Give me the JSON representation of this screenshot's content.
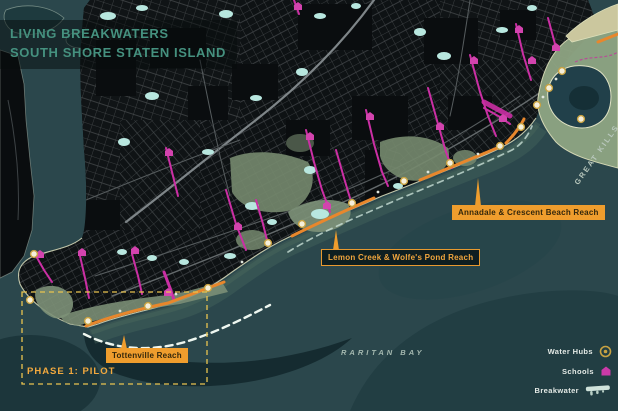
{
  "title": {
    "line1": "LIVING BREAKWATERS",
    "line2": "SOUTH SHORE STATEN ISLAND"
  },
  "map_labels": {
    "reach_annadale": "Annadale & Crescent Beach Reach",
    "reach_lemon": "Lemon Creek & Wolfe's Pond Reach",
    "reach_tottenville": "Tottenville Reach",
    "phase": "PHASE 1: PILOT",
    "bay": "RARITAN BAY",
    "great_kills": "GREAT KILLS"
  },
  "legend": {
    "items": [
      {
        "label": "Water Hubs",
        "icon": "water-hub-icon"
      },
      {
        "label": "Schools",
        "icon": "school-icon"
      },
      {
        "label": "Breakwater",
        "icon": "breakwater-icon"
      }
    ]
  },
  "colors": {
    "water": "#2B474C",
    "land": "#0A0D0F",
    "park_green": "#7D9178",
    "accent_orange": "#EF9D2D",
    "accent_pink": "#CB2FA4",
    "title_teal": "#45917F",
    "legend_gold": "#C9A342",
    "breakwater_white": "#EEF7F0",
    "phase_dash_yellow": "#E9C44F"
  }
}
